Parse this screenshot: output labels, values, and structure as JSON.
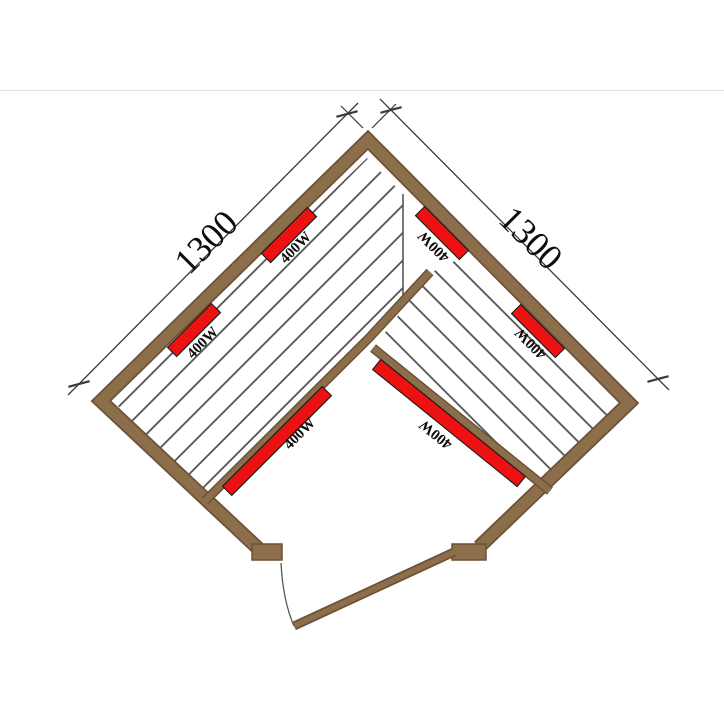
{
  "floorplan": {
    "dimension_labels": {
      "left": "1300",
      "right": "1300"
    },
    "heater_labels": {
      "left_wall_upper": "400W",
      "left_wall_lower": "400W",
      "right_wall_upper": "400W",
      "right_wall_lower": "400W",
      "bench_front_left": "400W",
      "bench_front_right": "400W"
    },
    "colors": {
      "wall": "#8d6e4b",
      "wall_edge": "#6b5238",
      "heater": "#ed1111",
      "heater_edge": "#1a1a1a",
      "hatch_line": "#4d4d4d",
      "dimension_line": "#3a3a3a",
      "label_text": "#0d0d0d",
      "divider": "#e2e2e2"
    }
  }
}
